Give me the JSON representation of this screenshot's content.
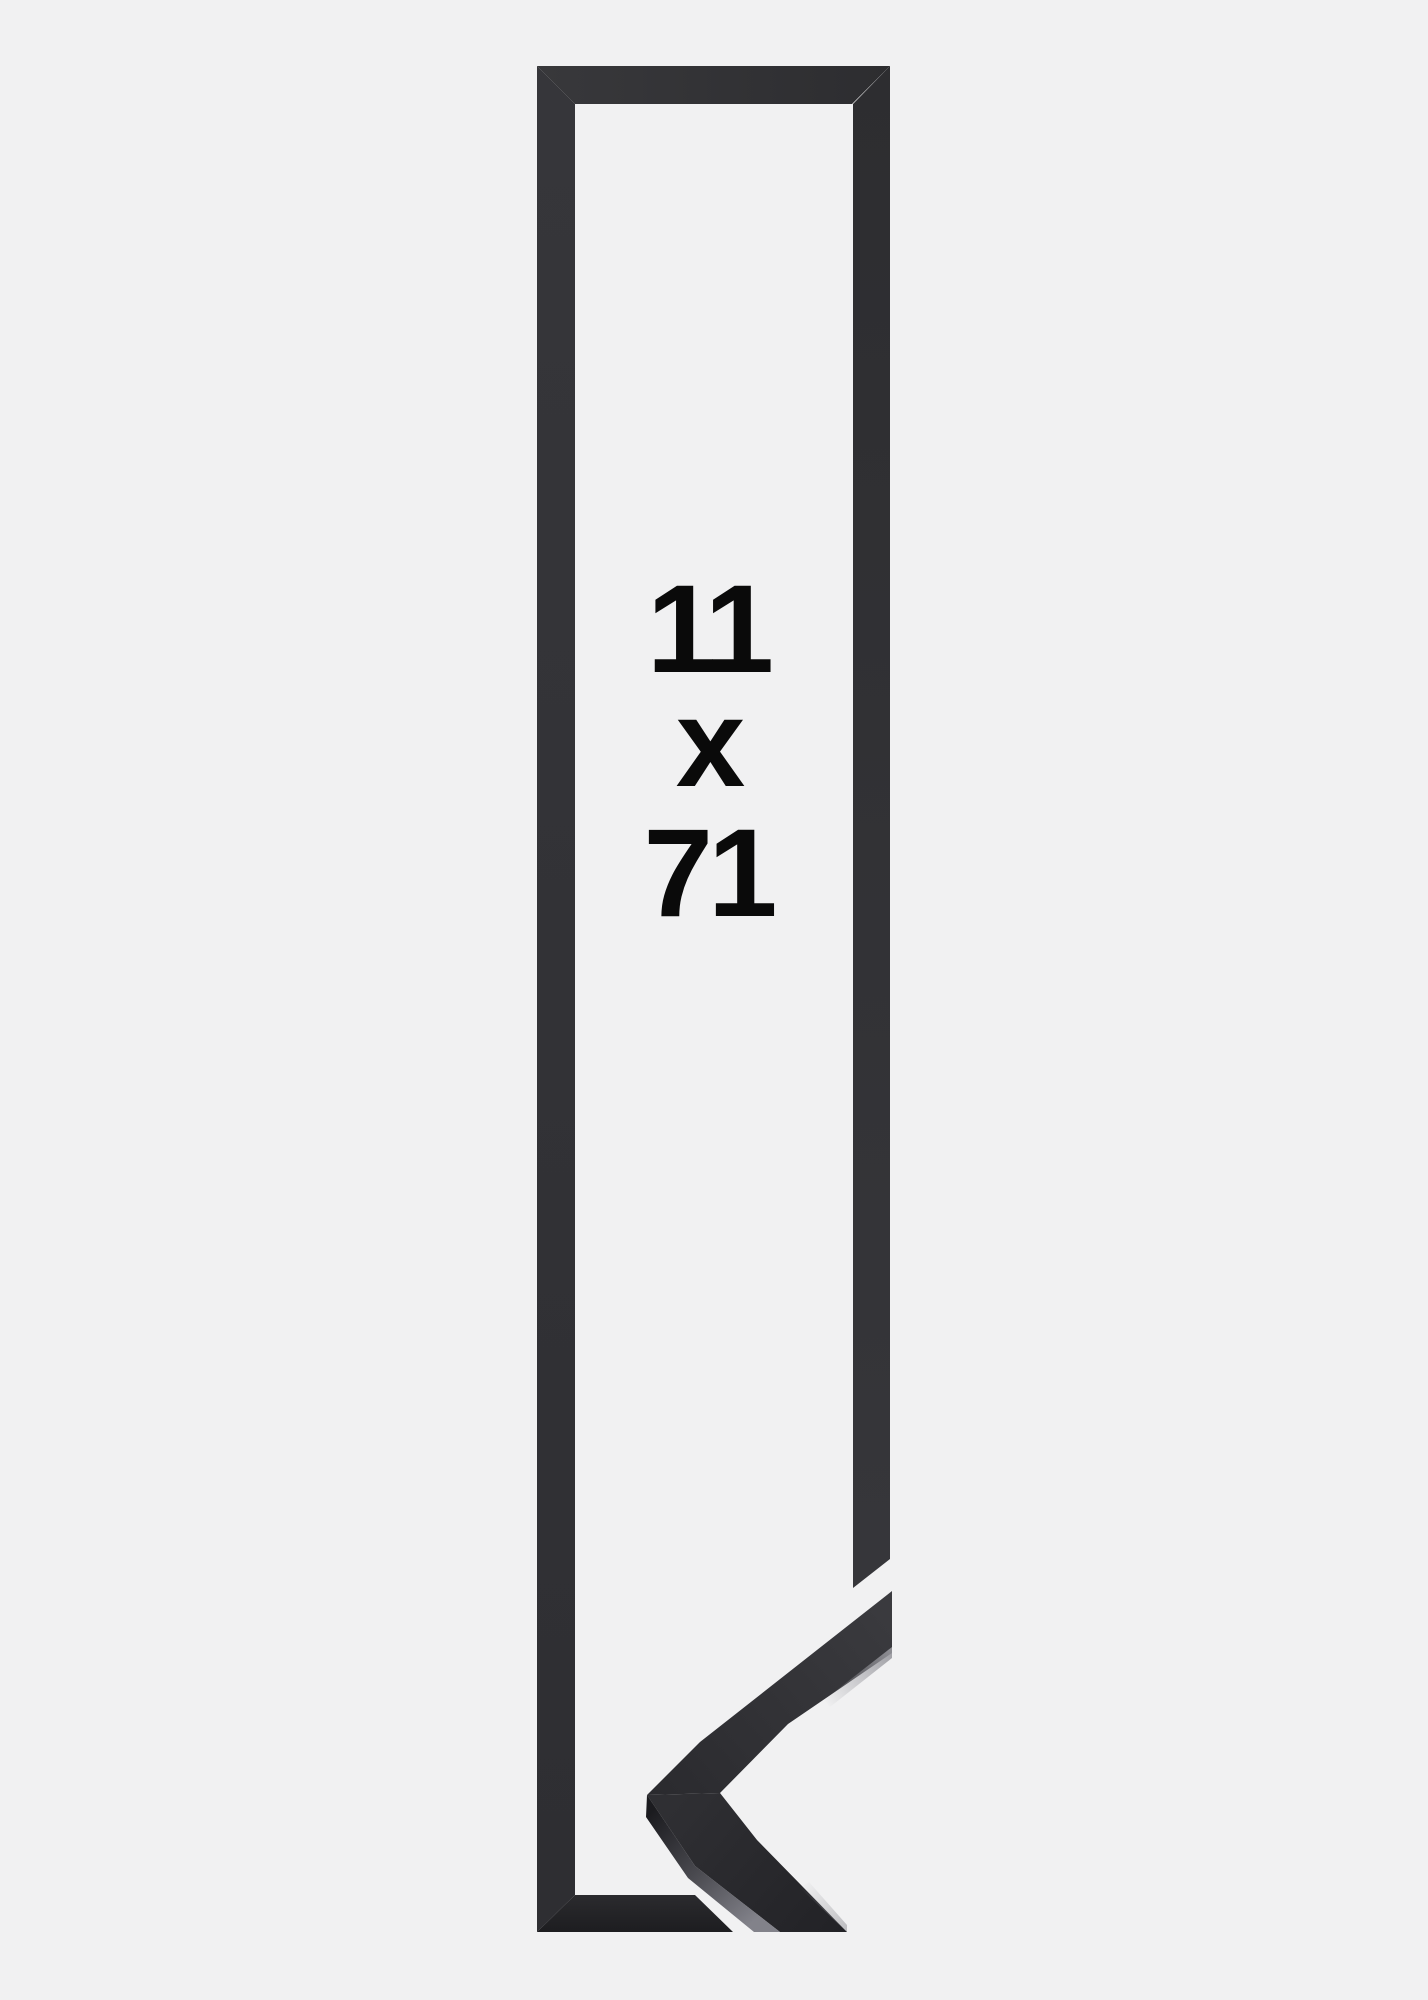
{
  "product_image": {
    "background_color": "#f1f1f2",
    "frame_color": "#303033",
    "frame_shadow_color": "#1d1d20",
    "moulding_side_color": "#82828a",
    "label_text_color": "#0a0a0a",
    "size_label": {
      "width": "11",
      "separator": "x",
      "height": "71"
    }
  }
}
